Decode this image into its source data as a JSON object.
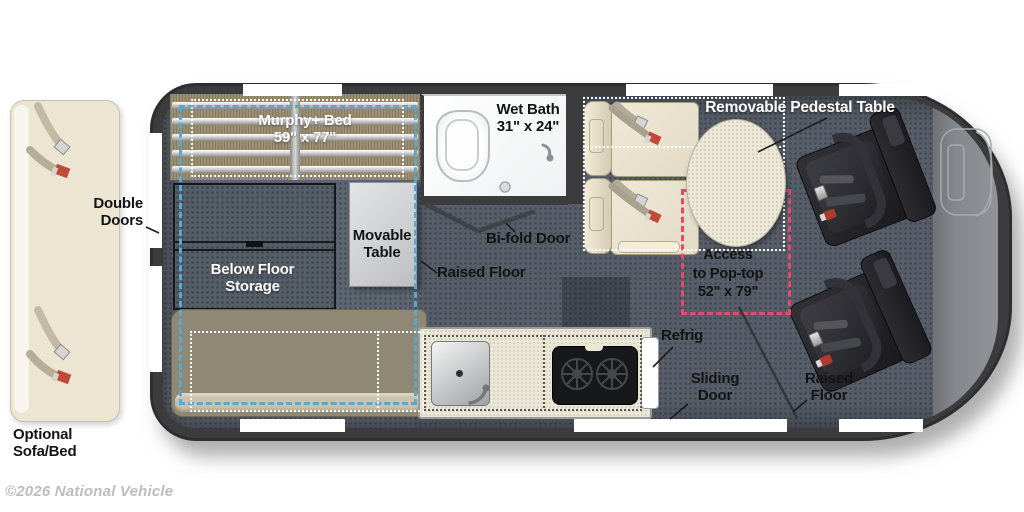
{
  "watermark": "©2026 National Vehicle",
  "colors": {
    "wall": "#3c3c3f",
    "floor": "#5d6570",
    "cab_floor": "#8a8d91",
    "bed_tan": "#998d72",
    "cream": "#ece6d4",
    "bench": "#8f8874",
    "blue_dash": "#57a8d3",
    "pink_dash": "#e8476f",
    "black_chair": "#232327",
    "label_white": "#ffffff",
    "label_black": "#141414",
    "watermark_gray": "#bdbdbd"
  },
  "areas": {
    "murphy_bed": {
      "name": "Murphy+ Bed",
      "dims": "59\" x 77\""
    },
    "wet_bath": {
      "name": "Wet Bath",
      "dims": "31\" x 24\""
    },
    "pedestal_table": {
      "name": "Removable Pedestal Table"
    },
    "double_doors": {
      "l1": "Double",
      "l2": "Doors"
    },
    "movable_table": {
      "l1": "Movable",
      "l2": "Table"
    },
    "below_floor_storage": {
      "l1": "Below Floor",
      "l2": "Storage"
    },
    "bifold_door": {
      "name": "Bi-fold Door"
    },
    "raised_floor_mid": {
      "name": "Raised Floor"
    },
    "pop_top": {
      "l1": "Access",
      "l2": "to Pop-top",
      "dims": "52\" x 79\""
    },
    "refrig": {
      "name": "Refrig"
    },
    "sliding_door": {
      "l1": "Sliding",
      "l2": "Door"
    },
    "raised_floor_front": {
      "l1": "Raised",
      "l2": "Floor"
    },
    "optional_sofa": {
      "l1": "Optional",
      "l2": "Sofa/Bed"
    }
  }
}
